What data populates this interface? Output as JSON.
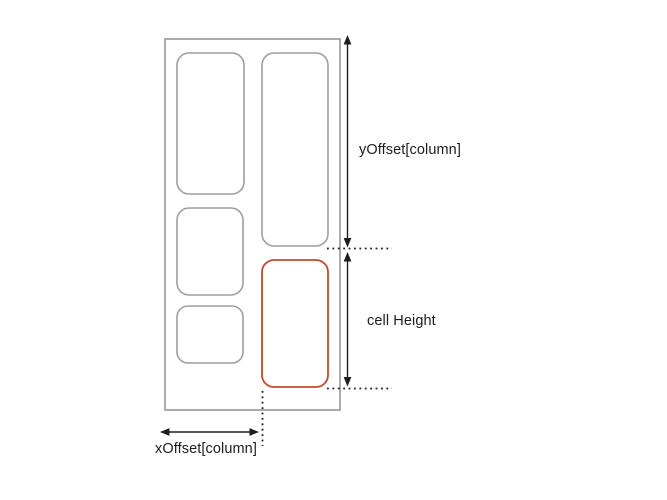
{
  "diagram": {
    "labels": {
      "y_offset": "yOffset[column]",
      "cell_height": "cell Height",
      "x_offset": "xOffset[column]"
    },
    "colors": {
      "container_stroke": "#9e9e9e",
      "cell_stroke": "#9e9e9e",
      "highlight_cell_stroke": "#c2492b",
      "ink": "#1d1d1d",
      "background": "#ffffff"
    }
  }
}
